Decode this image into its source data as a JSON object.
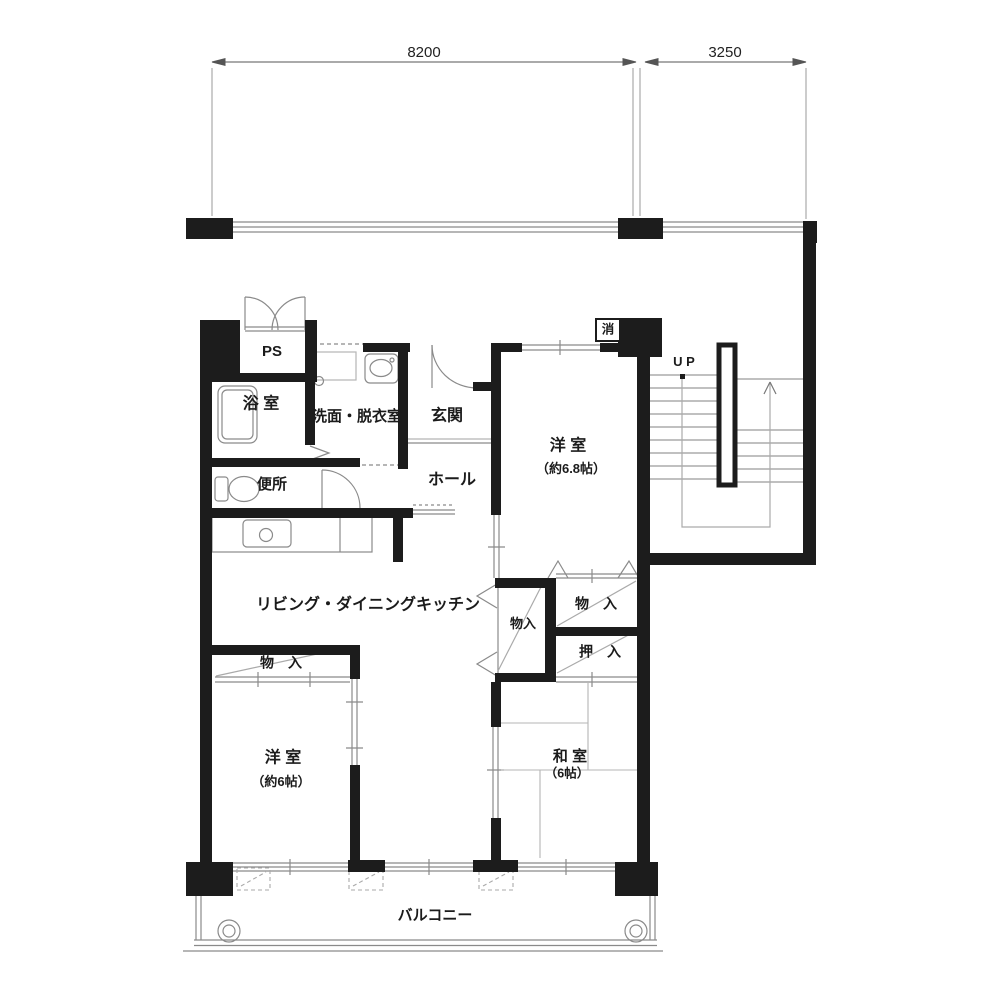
{
  "plan": {
    "dimensions": {
      "main": "8200",
      "stair": "3250"
    },
    "rooms": {
      "ps": "PS",
      "bathroom": "浴 室",
      "washroom": "洗面・脱衣室",
      "toilet": "便所",
      "entrance": "玄関",
      "hall": "ホール",
      "western1_name": "洋 室",
      "western1_size": "（約6.8帖）",
      "ldk": "リビング・ダイニングキッチン",
      "western2_name": "洋 室",
      "western2_size": "（約6帖）",
      "japanese_name": "和 室",
      "japanese_size": "（6帖）",
      "balcony": "バルコニー"
    },
    "storage": {
      "closet_west2": "物　入",
      "closet_center": "物入",
      "closet_upper": "物　入",
      "oshiire": "押　入"
    },
    "marks": {
      "up": "U P",
      "extinguisher": "消"
    }
  },
  "colors": {
    "wall": "#1c1c1c",
    "line": "#8a8a8a",
    "light": "#b5b5b5"
  }
}
